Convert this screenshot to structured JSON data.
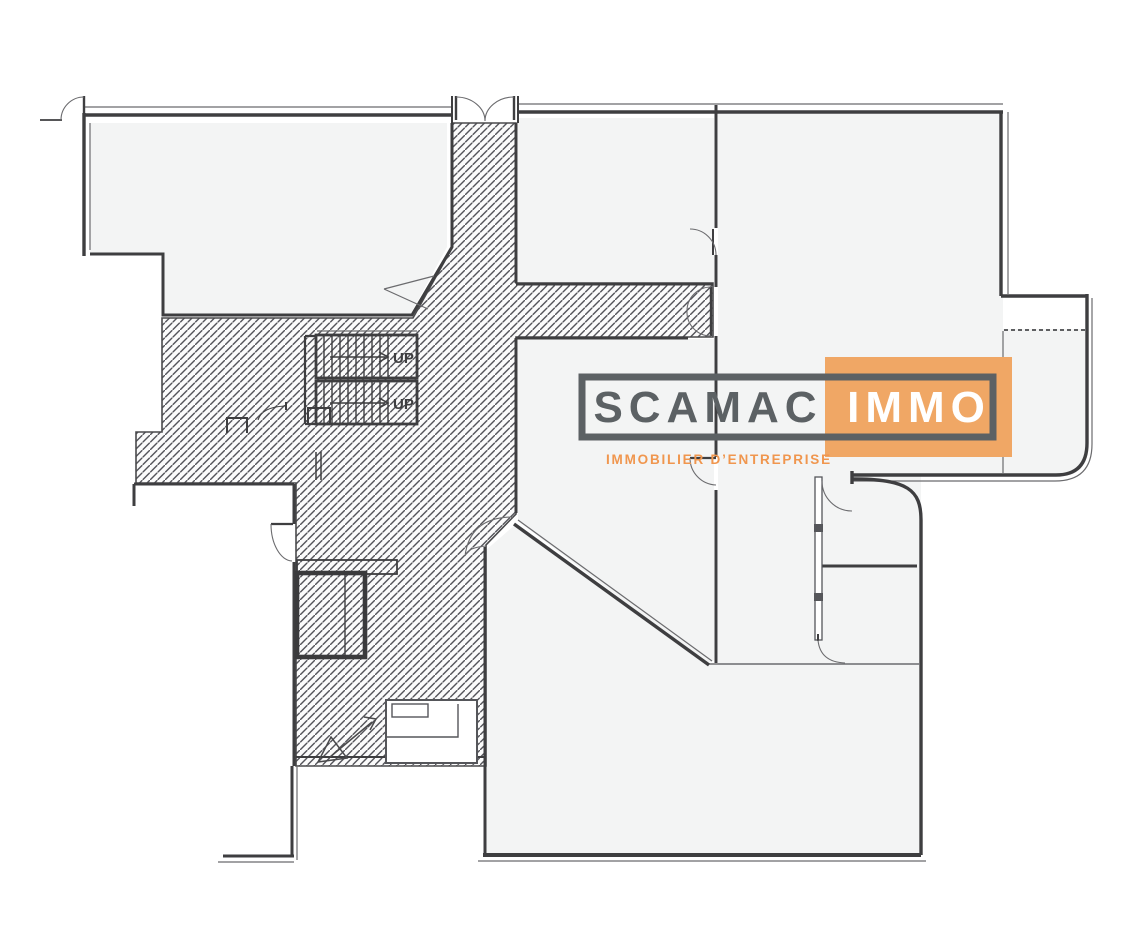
{
  "page": {
    "title": "Commercial floor plan",
    "background_hex": "#FFFFFF"
  },
  "logo": {
    "name": "SCAMAC IMMO",
    "left_text": "SCAMAC",
    "right_text": "IMMO",
    "tagline": "IMMOBILIER D’ENTREPRISE",
    "orange_hex": "#F0A765",
    "gray_hex": "#5C6164",
    "tagline_hex": "#F0964E",
    "immo_text_hex": "#FFFFFF"
  },
  "plan": {
    "wall_hex": "#3E3E40",
    "thin_line_hex": "#6B6B6E",
    "hatch_hex": "#54545A",
    "room_fill_hex": "#F3F4F4",
    "stairs": {
      "up_label_1": "UP",
      "up_label_2": "UP"
    }
  }
}
